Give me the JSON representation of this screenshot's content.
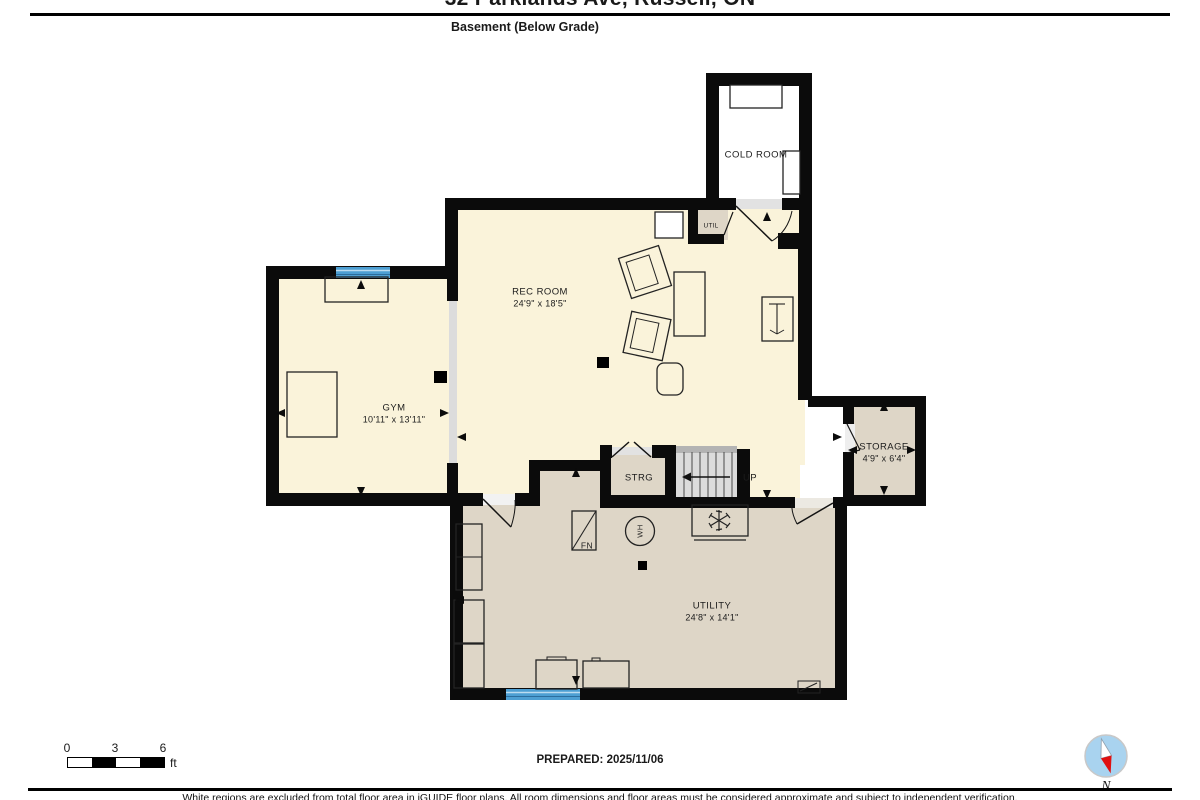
{
  "header": {
    "title": "32 Parklands Ave, Russell, ON",
    "subtitle": "Basement (Below Grade)"
  },
  "rooms": {
    "cold_room": {
      "name": "COLD ROOM"
    },
    "util_closet": {
      "name": "UTIL"
    },
    "rec_room": {
      "name": "REC ROOM",
      "dims": "24'9\" x 18'5\""
    },
    "gym": {
      "name": "GYM",
      "dims": "10'11\" x 13'11\""
    },
    "storage": {
      "name": "STORAGE",
      "dims": "4'9\" x 6'4\""
    },
    "strg": {
      "name": "STRG"
    },
    "stairs": {
      "direction_label": "UP"
    },
    "utility": {
      "name": "UTILITY",
      "dims": "24'8\" x 14'1\""
    },
    "furnace": {
      "label": "FN"
    },
    "water_heater": {
      "label": "WH"
    }
  },
  "scale_bar": {
    "tick_0": "0",
    "tick_3": "3",
    "tick_6": "6",
    "unit": "ft"
  },
  "compass": {
    "label": "N"
  },
  "footer": {
    "prepared": "PREPARED: 2025/11/06",
    "disclaimer": "White regions are excluded from total floor area in iGUIDE floor plans. All room dimensions and floor areas must be considered approximate and subject to independent verification."
  },
  "colors": {
    "floor_main": "#faf3da",
    "floor_secondary": "#ded6c7",
    "wall": "#0b0b0b",
    "window": "#4d9fd3",
    "opening": "#dcdcdc",
    "compass_face": "#a9d3ef",
    "compass_needle": "#e01010"
  }
}
